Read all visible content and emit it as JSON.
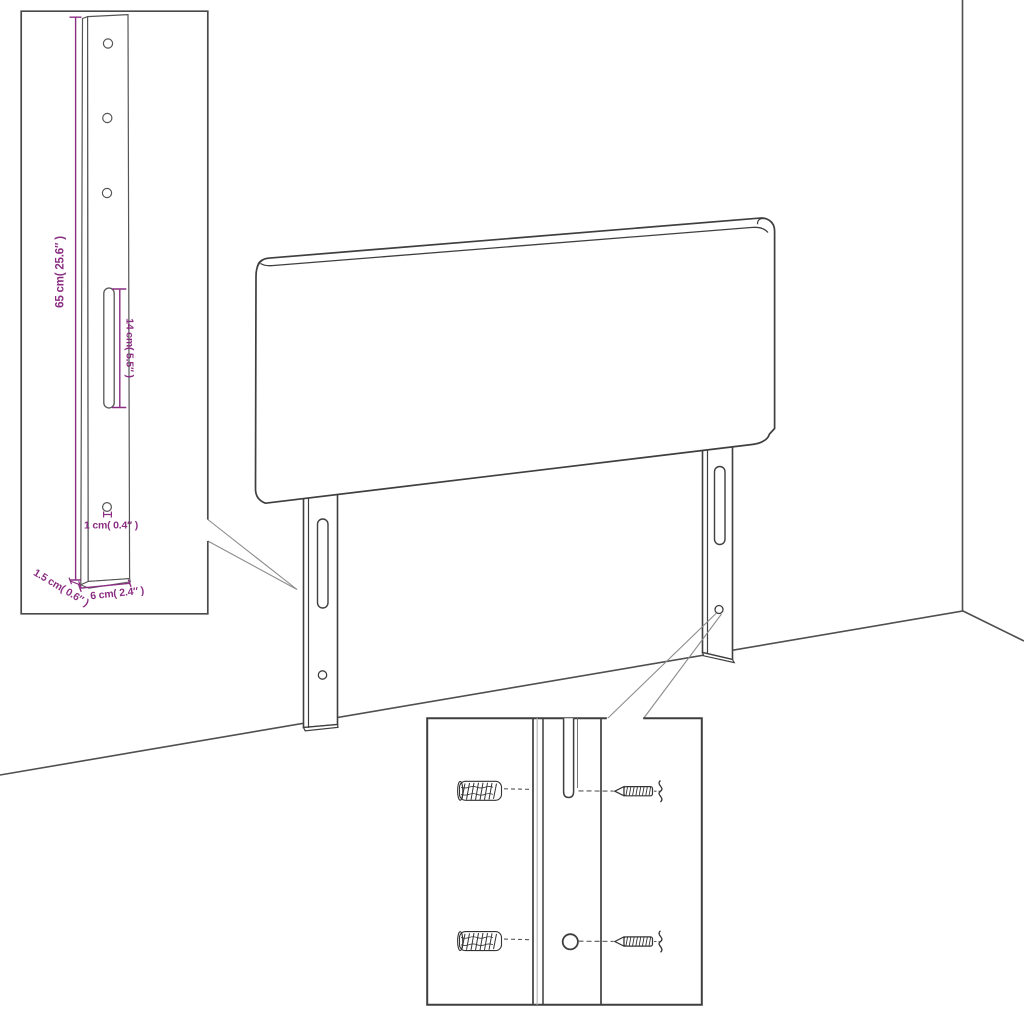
{
  "insets": {
    "bracket_detail": {
      "labels": {
        "height": "65 cm( 25.6″ )",
        "slot_length": "14 cm( 5.5″ )",
        "hole_diameter": "1 cm( 0.4″ )",
        "thickness": "1.5 cm( 0.6″ )",
        "width": "6 cm( 2.4″ )"
      }
    },
    "hardware_detail": {
      "icons": [
        "wall-anchor-icon",
        "screw-icon",
        "mounting-slot-icon",
        "mounting-hole-icon"
      ]
    }
  },
  "colors": {
    "dimension_accent": "#8b2e83",
    "line": "#3f3f3f",
    "callout_line": "#8c8c8c",
    "background": "#ffffff"
  }
}
